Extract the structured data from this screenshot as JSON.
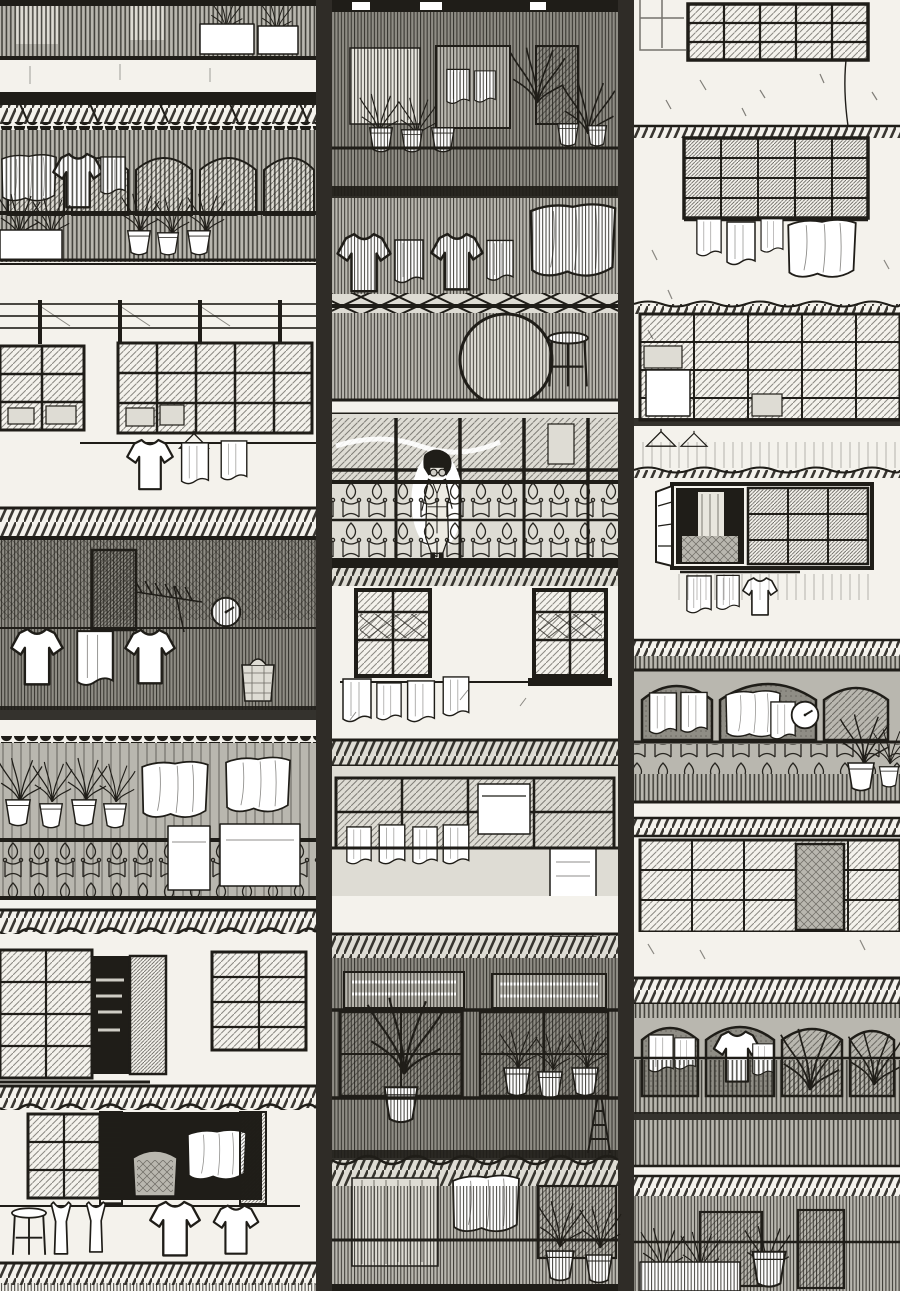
{
  "meta": {
    "title": "Crowded apartment facade",
    "medium": "black-and-white manga-style pen-and-ink illustration",
    "description": "Dense multi-storey apartment facade drawn in black-and-white manga ink style: three stacked tenement blocks covered with caged balconies of vertical bars, ornate iron railings, gridded glass windows, corrugated awnings, hanging white laundry, potted plants and planter boxes. A lone dark-haired resident with round glasses stands behind an ornamental railing on a central glazed balcony. Two round wall clocks, a TV antenna, a stool, a laundry basket and a stepladder are scattered among the floors.",
    "width_px": 900,
    "height_px": 1291
  },
  "palette": {
    "paper": "#f4f2ec",
    "ink": "#1f1d18",
    "tone-light": "#dedcd4",
    "tone-mid": "#b9b7af",
    "tone-dark": "#8f8d85",
    "white": "#ffffff"
  },
  "person": {
    "description": "resident with a dark bob haircut and round glasses, wearing a light robe, standing on a glazed balcony behind ornate ironwork",
    "location": "centre block, middle floor balcony"
  },
  "buildings": {
    "left": {
      "name": "left tenement block",
      "floors": [
        "barred balcony parapet with planter boxes",
        "concrete slab with rafter awning",
        "arched balcony with hanging laundry and rows of plant pots",
        "exposed beam band",
        "industrial gridded windows with clothesline of shirt and towels",
        "caged balcony with wall clock, TV antenna, shirts on a line and a laundry basket",
        "balcony with potted plants, draped sheets and towels over an ornate railing",
        "shuttered windows with an open pantry door",
        "open room with hanging sheet, wicker chair, stool and clothesline"
      ]
    },
    "middle": {
      "name": "centre caged block",
      "floors": [
        "caged balcony with curtains, doorway, hanging towels and plant pots",
        "caged balcony with laundry drying behind bars",
        "cross-braced rail, balcony with round basket and stool",
        "glazed balcony where the resident stands behind ornamental railing",
        "plaster wall with lattice-top windows and a towel line",
        "glazed floor with towel row, cabinet and a draped bath towel",
        "caged balcony with transom windows, potted plants and a stepladder",
        "lowest cage with draped sheet, curtain and flower pots"
      ]
    },
    "right": {
      "name": "right plaster block",
      "floors": [
        "large gridded window on white plaster",
        "second gridded window with laundry hanging below",
        "glazed band stacked with boxes, hangers on a rail",
        "open-shutter window revealing bedding, laundry below",
        "arched balcony with towels, wall clock, ornate railing and plants",
        "gridded window wall with dark doorway",
        "second arched balcony with laundry and tall potted plants",
        "barred parapet with planter boxes and flowers"
      ]
    }
  },
  "inventory": {
    "people": 1,
    "wall_clocks": 2,
    "tv_antennas": 1,
    "clotheslines": 6,
    "laundry_items": 38,
    "plant_pots_and_planters": 24,
    "windows": 22,
    "balconies": 13,
    "awnings": 9,
    "stools": 2,
    "laundry_baskets": 1,
    "stepladders": 1,
    "wicker_chairs": 1
  }
}
